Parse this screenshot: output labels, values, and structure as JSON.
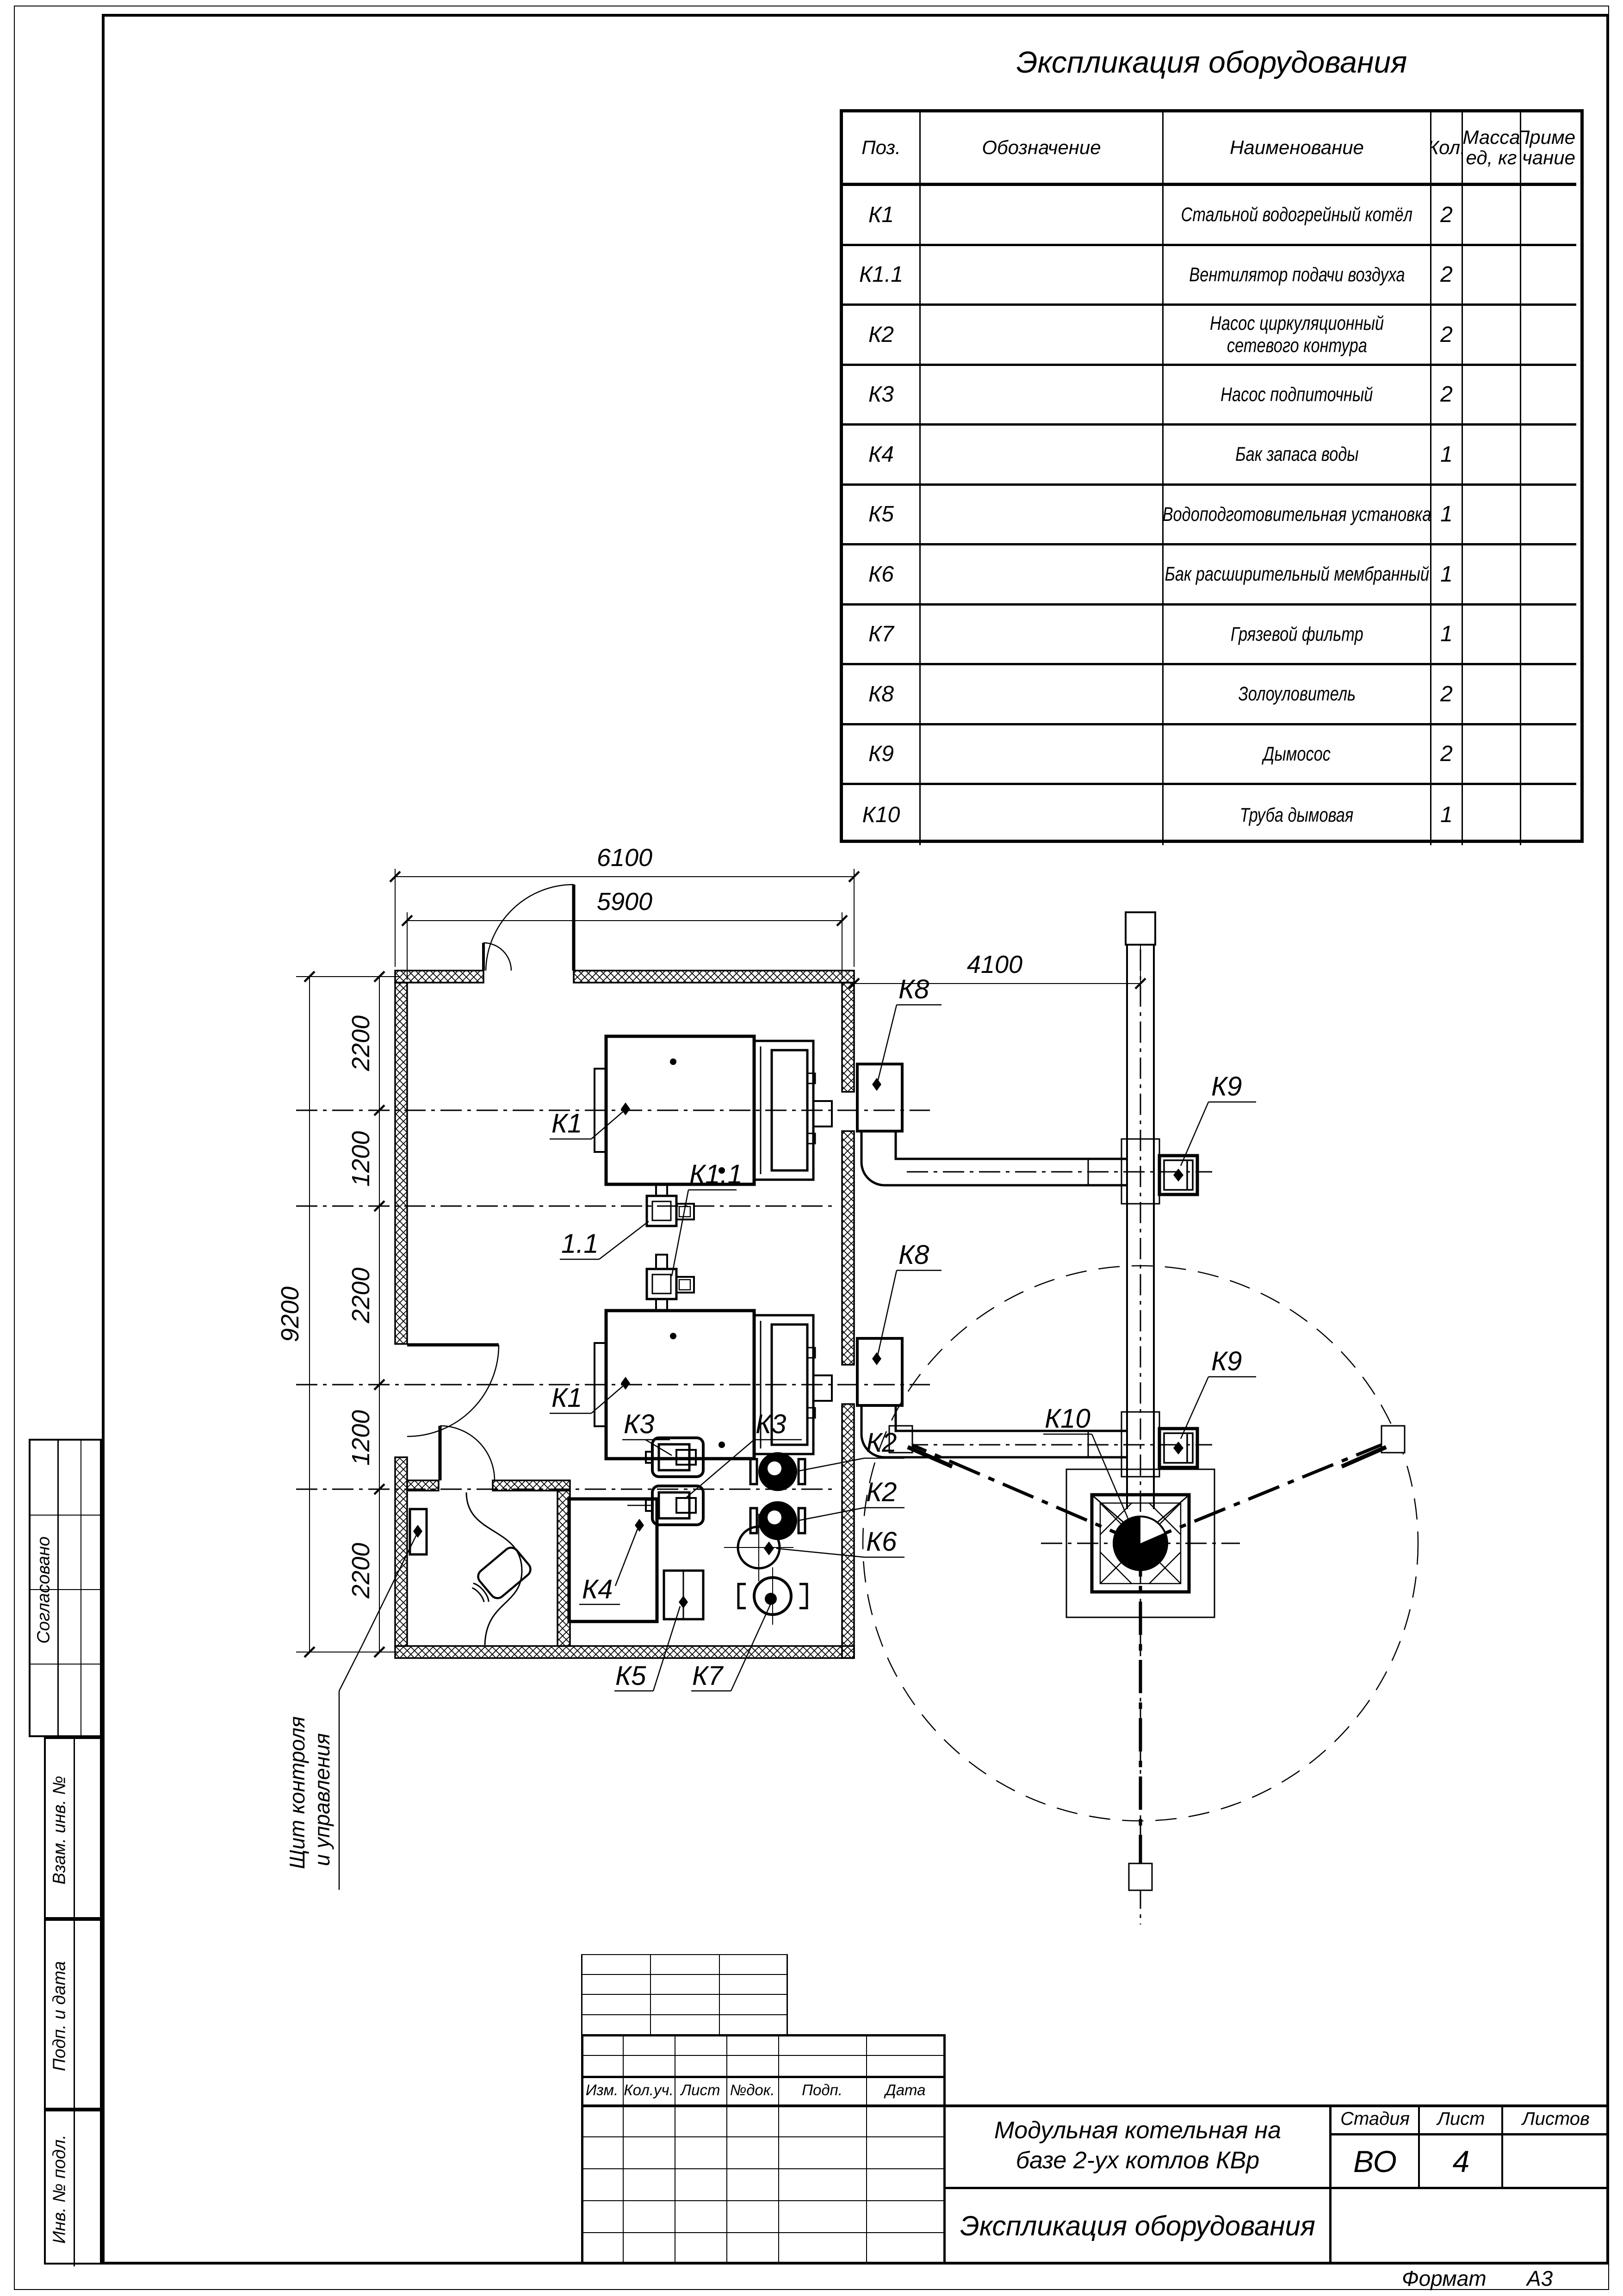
{
  "sheet": {
    "format_label": "Формат",
    "format_value": "А3"
  },
  "equipment_table": {
    "title": "Экспликация оборудования",
    "headers": {
      "pos": "Поз.",
      "designation": "Обозначение",
      "name": "Наименование",
      "qty": "Кол.",
      "mass_line1": "Масса",
      "mass_line2": "ед, кг",
      "note_line1": "Приме-",
      "note_line2": "чание"
    },
    "rows": [
      {
        "pos": "К1",
        "name": "Стальной водогрейный котёл",
        "qty": "2"
      },
      {
        "pos": "К1.1",
        "name": "Вентилятор подачи воздуха",
        "qty": "2"
      },
      {
        "pos": "К2",
        "name": "Насос циркуляционный",
        "name2": "сетевого контура",
        "qty": "2"
      },
      {
        "pos": "К3",
        "name": "Насос подпиточный",
        "qty": "2"
      },
      {
        "pos": "К4",
        "name": "Бак запаса воды",
        "qty": "1"
      },
      {
        "pos": "К5",
        "name": "Водоподготовительная установка",
        "qty": "1"
      },
      {
        "pos": "К6",
        "name": "Бак расширительный мембранный",
        "qty": "1"
      },
      {
        "pos": "К7",
        "name": "Грязевой фильтр",
        "qty": "1"
      },
      {
        "pos": "К8",
        "name": "Золоуловитель",
        "qty": "2"
      },
      {
        "pos": "К9",
        "name": "Дымосос",
        "qty": "2"
      },
      {
        "pos": "К10",
        "name": "Труба дымовая",
        "qty": "1"
      }
    ]
  },
  "plan": {
    "dimensions": {
      "width_outer": "6100",
      "width_inner": "5900",
      "right_span": "4100",
      "height_total": "9200",
      "seg1": "2200",
      "seg2": "1200",
      "seg3": "2200",
      "seg4": "1200",
      "seg5": "2200"
    },
    "labels": {
      "k1_1": "К1",
      "k1_2": "К1",
      "fan": "1.1",
      "k11": "К1.1",
      "k8_1": "К8",
      "k8_2": "К8",
      "k9_1": "К9",
      "k9_2": "К9",
      "k10": "К10",
      "k3_1": "К3",
      "k3_2": "К3",
      "k2_1": "К2",
      "k2_2": "К2",
      "k6": "К6",
      "k4": "К4",
      "k5": "К5",
      "k7": "К7",
      "panel1": "Щит контроля",
      "panel2": "и управления"
    }
  },
  "title_block": {
    "revision_columns": [
      "Изм.",
      "Кол.уч.",
      "Лист",
      "№док.",
      "Подп.",
      "Дата"
    ],
    "project_line1": "Модульная котельная на",
    "project_line2": "базе 2-ух котлов КВр",
    "doc_title": "Экспликация оборудования",
    "stage_label": "Стадия",
    "sheet_label": "Лист",
    "sheets_label": "Листов",
    "stage_value": "ВО",
    "sheet_value": "4"
  },
  "side_stamps": {
    "agreed": "Согласовано",
    "replace_inv": "Взам. инв. №",
    "sign_date": "Подп. и дата",
    "inv_orig": "Инв. № подл."
  }
}
